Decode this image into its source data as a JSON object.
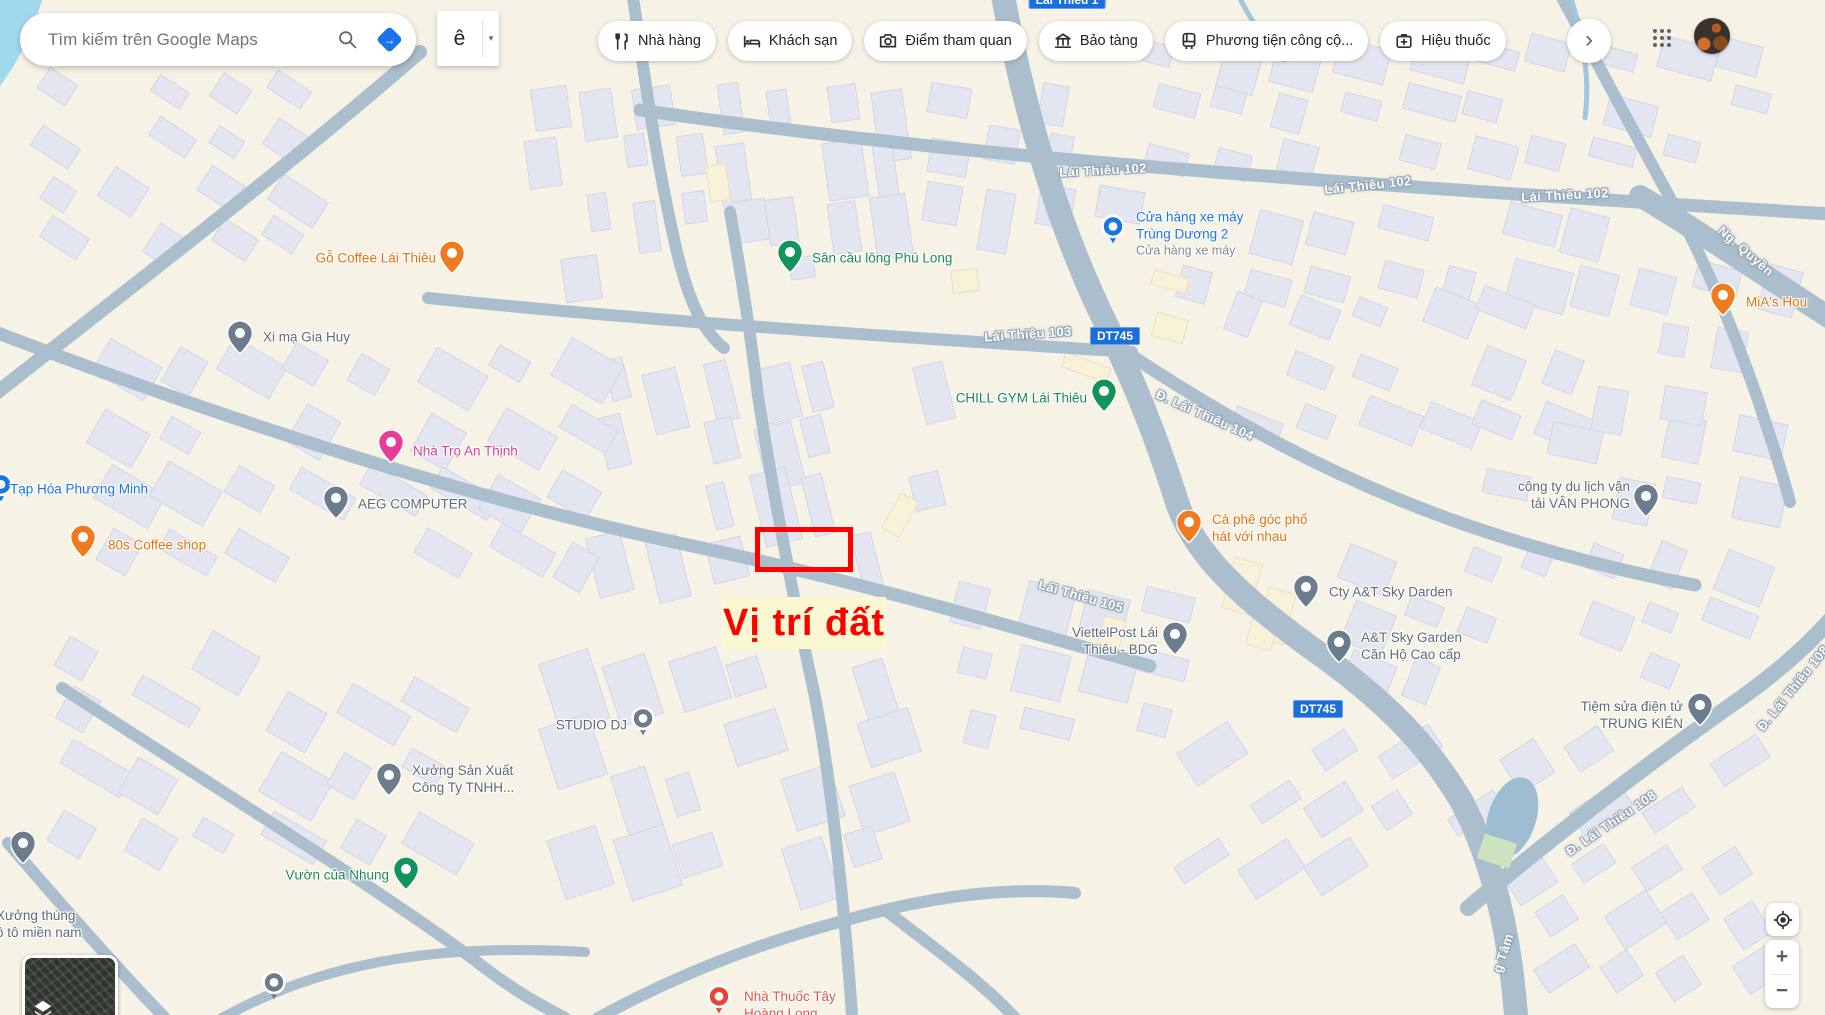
{
  "topbar": {
    "search": {
      "placeholder": "Tìm kiếm trên Google Maps"
    },
    "input_tool": {
      "label": "ê",
      "caret": "▾"
    },
    "chips": [
      {
        "label": "Nhà hàng"
      },
      {
        "label": "Khách sạn"
      },
      {
        "label": "Điểm tham quan"
      },
      {
        "label": "Bảo tàng"
      },
      {
        "label": "Phương tiện công cộ..."
      },
      {
        "label": "Hiệu thuốc"
      }
    ],
    "more_button": "›"
  },
  "map": {
    "palette": {
      "road": "#abbecd",
      "land": "#f6f2e5",
      "building": "#e3e6f0",
      "water": "#a0d8ee",
      "badge_bg": "#1a6ed8",
      "poi_blue": "#1a73e8",
      "poi_green": "#1b8a52",
      "poi_orange": "#e8710a",
      "poi_pink": "#df3a94",
      "poi_gray": "#5d6b76",
      "poi_red": "#df4a3d",
      "annotation_red": "#ff0000",
      "annotation_bg": "#fbf8d2"
    },
    "road_labels": [
      {
        "text": "Lái Thiêu 102",
        "x": 1103,
        "y": 170,
        "rot": -3
      },
      {
        "text": "Lái Thiêu 102",
        "x": 1368,
        "y": 185,
        "rot": -6
      },
      {
        "text": "Lái Thiêu 102",
        "x": 1565,
        "y": 195,
        "rot": -3
      },
      {
        "text": "Lái Thiêu 103",
        "x": 1028,
        "y": 334,
        "rot": -4
      },
      {
        "text": "Đ. Lái Thiêu 104",
        "x": 1205,
        "y": 415,
        "rot": 24
      },
      {
        "text": "Lái Thiêu 105",
        "x": 1081,
        "y": 596,
        "rot": 16
      },
      {
        "text": "Đ. Lái Thiêu 108",
        "x": 1611,
        "y": 823,
        "rot": -34
      },
      {
        "text": "Đ. Lái Thiêu 108",
        "x": 1793,
        "y": 688,
        "rot": -51
      },
      {
        "text": "Ng. Quyền",
        "x": 1746,
        "y": 251,
        "rot": 41
      },
      {
        "text": "g Tâm",
        "x": 1503,
        "y": 953,
        "rot": -72
      }
    ],
    "route_badges": [
      {
        "text": "DT745",
        "x": 1115,
        "y": 336
      },
      {
        "text": "DT745",
        "x": 1318,
        "y": 709
      },
      {
        "text": "Lái Thiêu 1",
        "x": 1067,
        "y": 0
      }
    ],
    "pois": [
      {
        "id": "go-coffee-lai-thieu",
        "type": "pin",
        "mx": 452,
        "my": 259,
        "mcolor": "#ef7b1e",
        "tx": 436,
        "ty": 258,
        "align": "right",
        "tcolor": "#e8710a",
        "lines": [
          "Gỗ Coffee Lái Thiêu"
        ]
      },
      {
        "id": "san-cau-long-phu-long",
        "type": "pin",
        "mx": 790,
        "my": 258,
        "mcolor": "#12945c",
        "tx": 812,
        "ty": 258,
        "align": "left",
        "tcolor": "#1b8a52",
        "lines": [
          "Sân cầu lông Phú Long"
        ]
      },
      {
        "id": "cua-hang-xe-may-trung-duong-2",
        "type": "circle",
        "mx": 1113,
        "my": 232,
        "mcolor": "#1a73e8",
        "tx": 1136,
        "ty": 234,
        "align": "left",
        "tcolor": "#1a73e8",
        "lines": [
          "Cửa hàng xe máy",
          "Trùng Dương 2"
        ],
        "sub": "Cửa hàng xe máy"
      },
      {
        "id": "mias-hou",
        "type": "pin",
        "mx": 1723,
        "my": 301,
        "mcolor": "#ef7b1e",
        "tx": 1746,
        "ty": 302,
        "align": "left",
        "tcolor": "#e8710a",
        "lines": [
          "MiA's Hou"
        ]
      },
      {
        "id": "xi-ma-gia-huy",
        "type": "pin",
        "mx": 240,
        "my": 339,
        "mcolor": "#6b7d8c",
        "tx": 263,
        "ty": 337,
        "align": "left",
        "tcolor": "#5d6b76",
        "lines": [
          "Xi mạ Gia Huy"
        ]
      },
      {
        "id": "chill-gym-lai-thieu",
        "type": "pin",
        "mx": 1104,
        "my": 397,
        "mcolor": "#12945c",
        "tx": 1087,
        "ty": 398,
        "align": "right",
        "tcolor": "#1b8a52",
        "lines": [
          "CHILL GYM Lái Thiêu"
        ]
      },
      {
        "id": "cong-ty-du-lich-van-tai-van-phong",
        "type": "pin",
        "mx": 1646,
        "my": 502,
        "mcolor": "#6b7d8c",
        "tx": 1630,
        "ty": 495,
        "align": "right",
        "tcolor": "#5d6b76",
        "lines": [
          "công ty du lịch vận",
          "tải VÂN PHONG"
        ]
      },
      {
        "id": "ca-phe-goc-pho-hat-voi-nhau",
        "type": "pin",
        "mx": 1189,
        "my": 528,
        "mcolor": "#ef7b1e",
        "tx": 1212,
        "ty": 528,
        "align": "left",
        "tcolor": "#e8710a",
        "lines": [
          "Cà phê góc phố",
          "hát với nhau"
        ]
      },
      {
        "id": "tap-hoa-phuong-minh",
        "type": "circle",
        "mx": 1,
        "my": 490,
        "mcolor": "#1a73e8",
        "tx": 10,
        "ty": 489,
        "align": "left",
        "tcolor": "#1a73e8",
        "lines": [
          "Tạp Hóa Phương Minh"
        ]
      },
      {
        "id": "nha-tro-an-thinh",
        "type": "pin",
        "mx": 391,
        "my": 448,
        "mcolor": "#e83c97",
        "tx": 413,
        "ty": 451,
        "align": "left",
        "tcolor": "#df3a94",
        "lines": [
          "Nhà Trọ An Thịnh"
        ]
      },
      {
        "id": "aeg-computer",
        "type": "pin",
        "mx": 336,
        "my": 504,
        "mcolor": "#6b7d8c",
        "tx": 358,
        "ty": 504,
        "align": "left",
        "tcolor": "#5d6b76",
        "lines": [
          "AEG COMPUTER"
        ]
      },
      {
        "id": "80s-coffee-shop",
        "type": "pin",
        "mx": 83,
        "my": 543,
        "mcolor": "#ef7b1e",
        "tx": 108,
        "ty": 545,
        "align": "left",
        "tcolor": "#e8710a",
        "lines": [
          "80s Coffee shop"
        ]
      },
      {
        "id": "cty-at-sky-darden",
        "type": "pin",
        "mx": 1306,
        "my": 593,
        "mcolor": "#6b7d8c",
        "tx": 1329,
        "ty": 592,
        "align": "left",
        "tcolor": "#5d6b76",
        "lines": [
          "Cty A&T Sky Darden"
        ]
      },
      {
        "id": "at-sky-garden-can-ho-cao-cap",
        "type": "pin",
        "mx": 1339,
        "my": 648,
        "mcolor": "#6b7d8c",
        "tx": 1361,
        "ty": 646,
        "align": "left",
        "tcolor": "#5d6b76",
        "lines": [
          "A&T Sky Garden",
          "Căn Hộ Cao cấp"
        ]
      },
      {
        "id": "viettelpost-lai-thieu-bdg",
        "type": "pin",
        "mx": 1175,
        "my": 640,
        "mcolor": "#6b7d8c",
        "tx": 1158,
        "ty": 641,
        "align": "right",
        "tcolor": "#5d6b76",
        "lines": [
          "ViettelPost Lái",
          "Thiêu - BDG"
        ]
      },
      {
        "id": "tiem-sua-dien-tu-trung-kien",
        "type": "pin",
        "mx": 1700,
        "my": 711,
        "mcolor": "#6b7d8c",
        "tx": 1683,
        "ty": 715,
        "align": "right",
        "tcolor": "#5d6b76",
        "lines": [
          "Tiệm sửa điện tử",
          "TRUNG KIÊN"
        ]
      },
      {
        "id": "studio-dj",
        "type": "circle",
        "mx": 643,
        "my": 724,
        "mcolor": "#6b7d8c",
        "tx": 627,
        "ty": 725,
        "align": "right",
        "tcolor": "#5d6b76",
        "lines": [
          "STUDIO DJ"
        ]
      },
      {
        "id": "xuong-san-xuat-cong-ty-tnhh",
        "type": "pin",
        "mx": 389,
        "my": 781,
        "mcolor": "#6b7d8c",
        "tx": 412,
        "ty": 779,
        "align": "left",
        "tcolor": "#5d6b76",
        "lines": [
          "Xưởng Sản Xuất",
          "Công Ty TNHH..."
        ]
      },
      {
        "id": "vuon-cua-nhung",
        "type": "pin",
        "mx": 406,
        "my": 875,
        "mcolor": "#12945c",
        "tx": 389,
        "ty": 875,
        "align": "right",
        "tcolor": "#1b8a52",
        "lines": [
          "Vườn của Nhung"
        ]
      },
      {
        "id": "xuong-thung-o-to-mien-nam",
        "type": "pin",
        "mx": 23,
        "my": 849,
        "mcolor": "#6b7d8c",
        "tx": -4,
        "ty": 924,
        "align": "left",
        "tcolor": "#5d6b76",
        "lines": [
          "Xưởng thùng",
          "ô tô miền nam"
        ]
      },
      {
        "id": "nha-thuoc-tay-hoang-long",
        "type": "circle",
        "mx": 719,
        "my": 1002,
        "mcolor": "#e94335",
        "tx": 744,
        "ty": 1005,
        "align": "left",
        "tcolor": "#e25548",
        "lines": [
          "Nhà Thuốc Tây",
          "Hoàng Long"
        ]
      },
      {
        "id": "school-poi",
        "type": "circle",
        "mx": 274,
        "my": 988,
        "mcolor": "#6b7d8c",
        "tx": 0,
        "ty": 0,
        "align": "left",
        "tcolor": "#5d6b76",
        "lines": []
      }
    ],
    "annotation": {
      "label": "Vị trí đất"
    },
    "controls": {
      "zoom_in": "+",
      "zoom_out": "−"
    }
  }
}
